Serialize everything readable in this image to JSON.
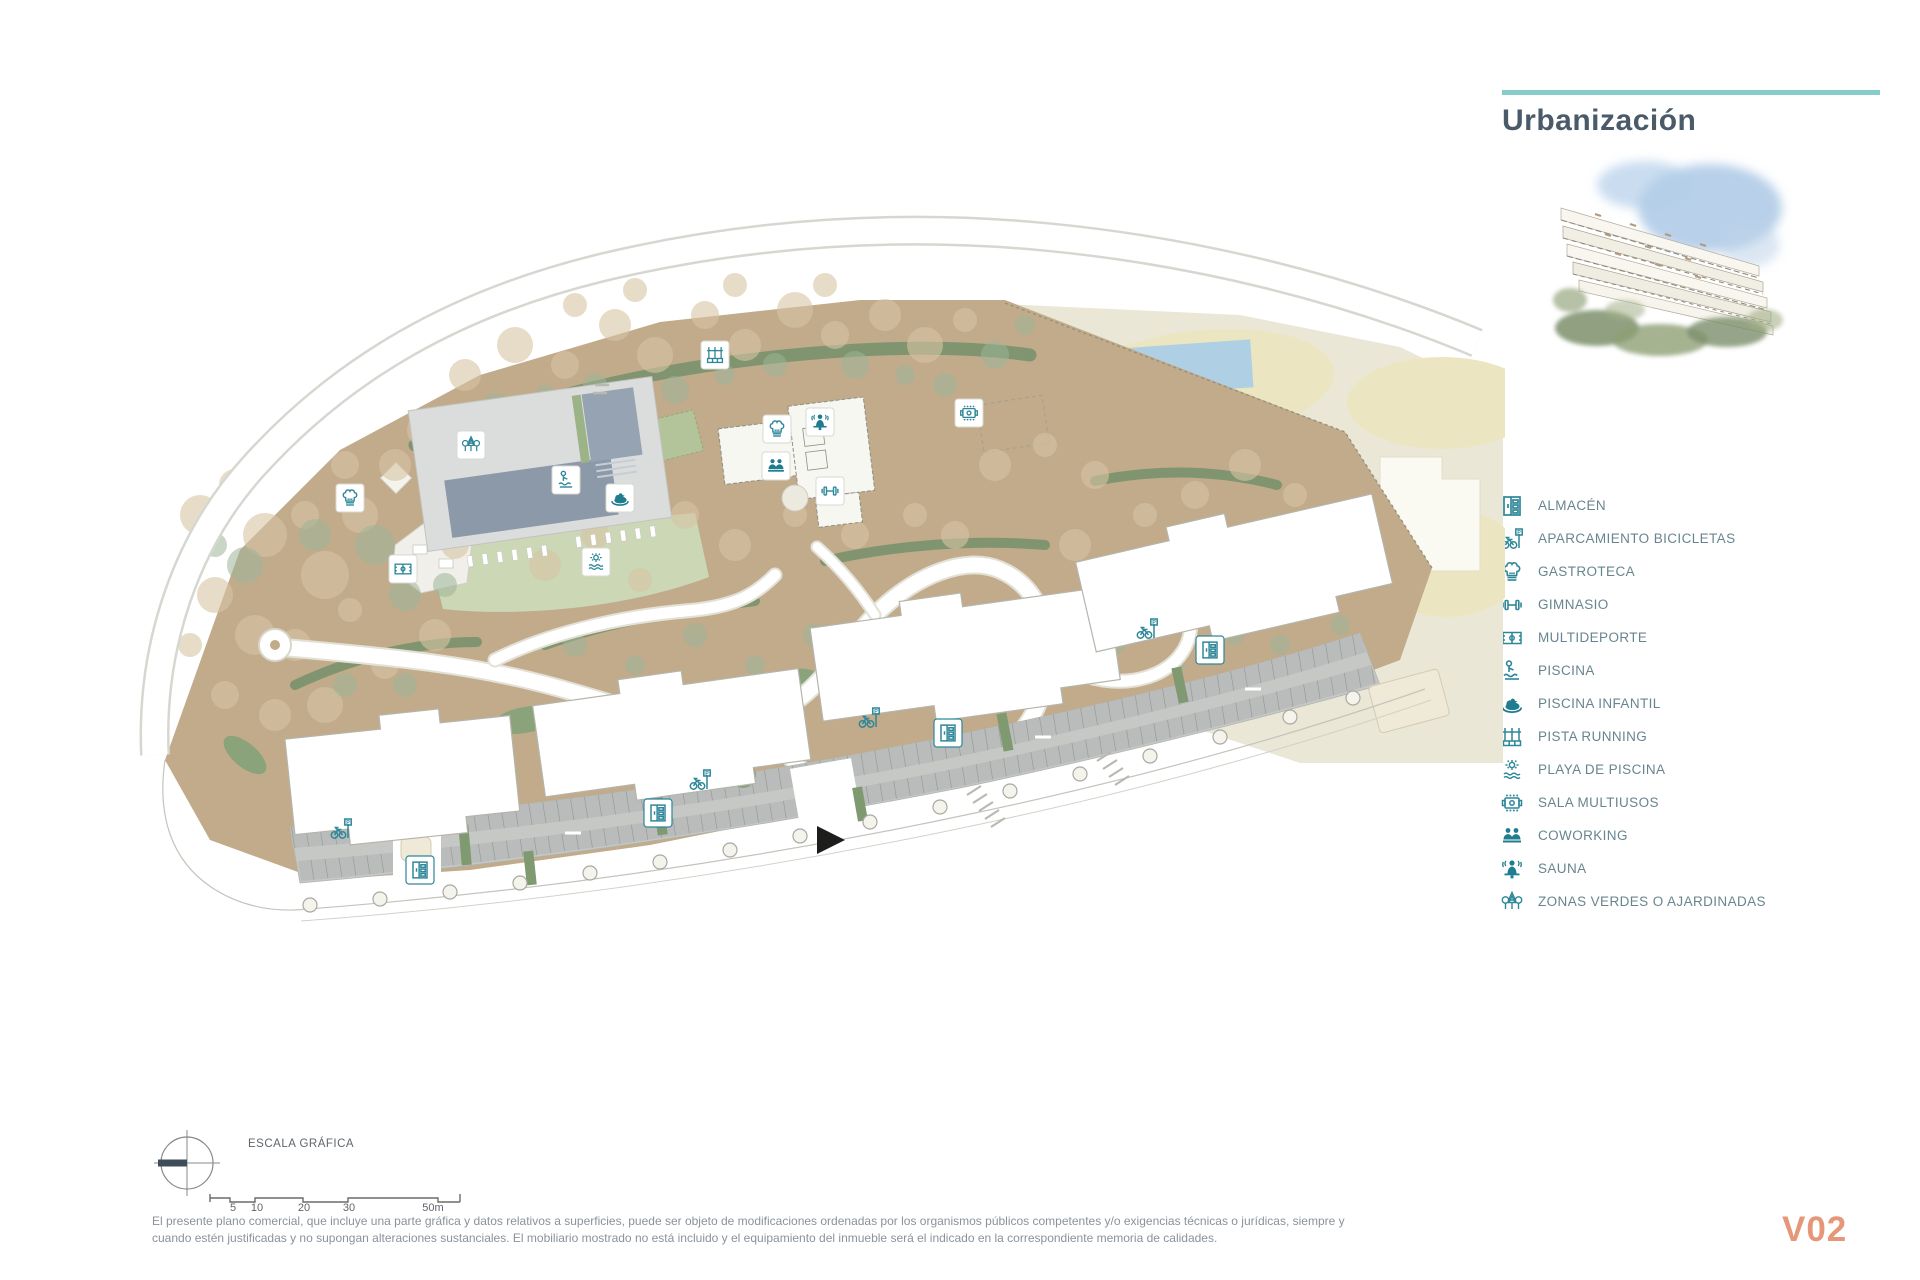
{
  "header": {
    "title": "Urbanización"
  },
  "hero_image": {
    "description": "watercolor-apartment-building-thumbnail"
  },
  "legend": {
    "items": [
      {
        "icon": "storage-icon",
        "label": "ALMACÉN"
      },
      {
        "icon": "bike-parking-icon",
        "label": "APARCAMIENTO BICICLETAS"
      },
      {
        "icon": "chef-hat-icon",
        "label": "GASTROTECA"
      },
      {
        "icon": "dumbbell-icon",
        "label": "GIMNASIO"
      },
      {
        "icon": "sports-court-icon",
        "label": "MULTIDEPORTE"
      },
      {
        "icon": "swimmer-icon",
        "label": "PISCINA"
      },
      {
        "icon": "rubber-duck-icon",
        "label": "PISCINA INFANTIL"
      },
      {
        "icon": "running-track-icon",
        "label": "PISTA RUNNING"
      },
      {
        "icon": "sun-waves-icon",
        "label": "PLAYA DE PISCINA"
      },
      {
        "icon": "meeting-table-icon",
        "label": "SALA MULTIUSOS"
      },
      {
        "icon": "people-desk-icon",
        "label": "COWORKING"
      },
      {
        "icon": "sauna-person-icon",
        "label": "SAUNA"
      },
      {
        "icon": "trees-icon",
        "label": "ZONAS VERDES O AJARDINADAS"
      }
    ]
  },
  "plan": {
    "marker_icons": [
      "gastroteca",
      "zonas-verdes",
      "multideporte",
      "piscina",
      "piscina-infantil",
      "playa-de-piscina",
      "pista-running",
      "gastroteca",
      "sauna",
      "coworking",
      "gimnasio",
      "sala-multiusos",
      "almacen",
      "almacen",
      "almacen",
      "almacen",
      "aparcamiento-bicicletas",
      "aparcamiento-bicicletas",
      "aparcamiento-bicicletas",
      "aparcamiento-bicicletas"
    ],
    "entrance_marker": "black-arrow-east"
  },
  "footer": {
    "scale_label": "ESCALA GRÁFICA",
    "scale_ticks": [
      "5",
      "10",
      "20",
      "30",
      "50m"
    ],
    "disclaimer_line1": "El presente plano comercial, que incluye una parte gráfica y datos relativos a superficies, puede ser objeto de modificaciones ordenadas por los organismos públicos competentes y/o exigencias técnicas o jurídicas, siempre y",
    "disclaimer_line2": "cuando estén justificadas y no supongan alteraciones sustanciales. El mobiliario mostrado no está incluido y el equipamiento del inmueble será el indicado en la correspondiente memoria de calidades.",
    "version": "V02"
  },
  "colors": {
    "accent_teal": "#2d8799",
    "divider_teal": "#86cdc9",
    "title_text": "#4b5a68",
    "legend_text": "#68858f",
    "version_orange": "#e6977a",
    "ground_tan": "#c1ab8b",
    "vegetation_green": "#7f9a70",
    "lawn_green": "#ccd7b5",
    "pool_water": "#8c99a8",
    "outside_beige": "#eae7d7",
    "neighbor_pool_blue": "#aecfe4",
    "parking_gray": "#c6c8c6"
  }
}
